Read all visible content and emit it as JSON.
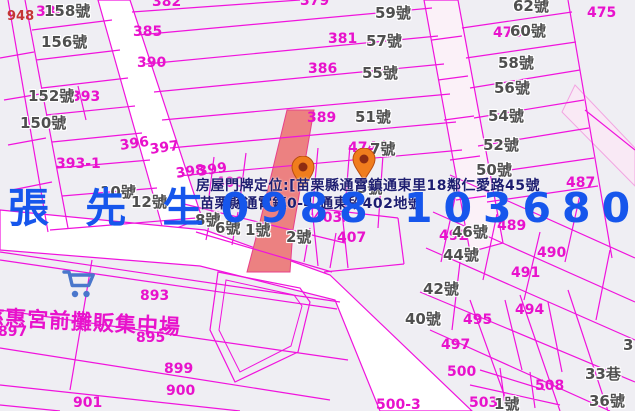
{
  "map": {
    "overlay": {
      "contact_name": "張 先 生",
      "contact_phone": "0988 103680",
      "address_line1": "房屋門牌定位:[苗栗縣通霄鎮通東里18鄰仁愛路45號",
      "address_line2": "苗栗縣通霄鎮0-4 通東段402地號"
    },
    "market_label": "慈惠宮前攤販集中場",
    "icons": {
      "market": "shopping-cart-icon",
      "marker": "location-pin-icon"
    },
    "colors": {
      "parcel_line": "#f013dd",
      "label_magenta": "#e812cc",
      "label_grey": "#4f4f4f",
      "label_red": "#c43535",
      "overlay_blue": "#1656ec",
      "address_navy": "#1d1d70",
      "highlight_parcel": "#ec8181",
      "marker_orange": "#f07d1d",
      "cart_blue": "#4a77cc",
      "road_white": "#ffffff",
      "map_background": "#efeef3"
    },
    "markers": [
      {
        "x": 303,
        "y": 194
      },
      {
        "x": 364,
        "y": 186
      }
    ],
    "labels": [
      {
        "t": "382",
        "x": 152,
        "y": -5,
        "c": "m"
      },
      {
        "t": "379",
        "x": 300,
        "y": -6,
        "c": "m"
      },
      {
        "t": "384",
        "x": 36,
        "y": 5,
        "c": "m"
      },
      {
        "t": "385",
        "x": 133,
        "y": 25,
        "c": "m"
      },
      {
        "t": "381",
        "x": 328,
        "y": 32,
        "c": "m"
      },
      {
        "t": "390",
        "x": 137,
        "y": 56,
        "c": "m"
      },
      {
        "t": "386",
        "x": 308,
        "y": 62,
        "c": "m"
      },
      {
        "t": "389",
        "x": 307,
        "y": 111,
        "c": "m"
      },
      {
        "t": "393",
        "x": 71,
        "y": 90,
        "c": "m"
      },
      {
        "t": "393-1",
        "x": 56,
        "y": 157,
        "c": "m"
      },
      {
        "t": "396",
        "x": 119,
        "y": 139,
        "c": "m",
        "rot": -8
      },
      {
        "t": "397",
        "x": 149,
        "y": 143,
        "c": "m",
        "rot": -8
      },
      {
        "t": "398",
        "x": 175,
        "y": 167,
        "c": "m",
        "rot": -8
      },
      {
        "t": "399",
        "x": 197,
        "y": 165,
        "c": "m",
        "rot": -8
      },
      {
        "t": "400",
        "x": 215,
        "y": 176,
        "c": "m"
      },
      {
        "t": "403",
        "x": 313,
        "y": 211,
        "c": "m"
      },
      {
        "t": "407",
        "x": 337,
        "y": 231,
        "c": "m"
      },
      {
        "t": "474",
        "x": 348,
        "y": 141,
        "c": "m"
      },
      {
        "t": "476",
        "x": 493,
        "y": 26,
        "c": "m"
      },
      {
        "t": "475",
        "x": 587,
        "y": 6,
        "c": "m"
      },
      {
        "t": "487",
        "x": 566,
        "y": 176,
        "c": "m"
      },
      {
        "t": "489",
        "x": 497,
        "y": 219,
        "c": "m"
      },
      {
        "t": "492",
        "x": 439,
        "y": 229,
        "c": "m"
      },
      {
        "t": "490",
        "x": 537,
        "y": 246,
        "c": "m"
      },
      {
        "t": "491",
        "x": 511,
        "y": 266,
        "c": "m"
      },
      {
        "t": "494",
        "x": 515,
        "y": 303,
        "c": "m"
      },
      {
        "t": "495",
        "x": 463,
        "y": 313,
        "c": "m"
      },
      {
        "t": "497",
        "x": 441,
        "y": 338,
        "c": "m"
      },
      {
        "t": "500",
        "x": 447,
        "y": 365,
        "c": "m"
      },
      {
        "t": "508",
        "x": 535,
        "y": 379,
        "c": "m"
      },
      {
        "t": "503",
        "x": 469,
        "y": 396,
        "c": "m"
      },
      {
        "t": "500-3",
        "x": 376,
        "y": 398,
        "c": "m"
      },
      {
        "t": "893",
        "x": 140,
        "y": 289,
        "c": "m"
      },
      {
        "t": "895",
        "x": 136,
        "y": 331,
        "c": "m"
      },
      {
        "t": "897",
        "x": -2,
        "y": 325,
        "c": "m"
      },
      {
        "t": "899",
        "x": 164,
        "y": 362,
        "c": "m"
      },
      {
        "t": "900",
        "x": 166,
        "y": 384,
        "c": "m"
      },
      {
        "t": "901",
        "x": 73,
        "y": 396,
        "c": "m"
      },
      {
        "t": "158號",
        "x": 44,
        "y": 4,
        "c": "g"
      },
      {
        "t": "156號",
        "x": 41,
        "y": 35,
        "c": "g"
      },
      {
        "t": "152號",
        "x": 28,
        "y": 89,
        "c": "g"
      },
      {
        "t": "150號",
        "x": 20,
        "y": 116,
        "c": "g"
      },
      {
        "t": "59號",
        "x": 375,
        "y": 6,
        "c": "g"
      },
      {
        "t": "57號",
        "x": 366,
        "y": 34,
        "c": "g"
      },
      {
        "t": "55號",
        "x": 362,
        "y": 66,
        "c": "g"
      },
      {
        "t": "51號",
        "x": 355,
        "y": 110,
        "c": "g"
      },
      {
        "t": "62號",
        "x": 513,
        "y": -1,
        "c": "g"
      },
      {
        "t": "60號",
        "x": 510,
        "y": 24,
        "c": "g"
      },
      {
        "t": "58號",
        "x": 498,
        "y": 56,
        "c": "g"
      },
      {
        "t": "56號",
        "x": 494,
        "y": 81,
        "c": "g"
      },
      {
        "t": "54號",
        "x": 488,
        "y": 109,
        "c": "g"
      },
      {
        "t": "52號",
        "x": 483,
        "y": 138,
        "c": "g"
      },
      {
        "t": "50號",
        "x": 476,
        "y": 163,
        "c": "g"
      },
      {
        "t": "7號",
        "x": 370,
        "y": 142,
        "c": "g"
      },
      {
        "t": "5號",
        "x": 357,
        "y": 181,
        "c": "g"
      },
      {
        "t": "10號",
        "x": 100,
        "y": 185,
        "c": "g"
      },
      {
        "t": "12號",
        "x": 131,
        "y": 195,
        "c": "g"
      },
      {
        "t": "8號",
        "x": 195,
        "y": 213,
        "c": "g"
      },
      {
        "t": "6號",
        "x": 215,
        "y": 221,
        "c": "g"
      },
      {
        "t": "1號",
        "x": 245,
        "y": 223,
        "c": "g"
      },
      {
        "t": "2號",
        "x": 286,
        "y": 230,
        "c": "g"
      },
      {
        "t": "46號",
        "x": 452,
        "y": 225,
        "c": "g"
      },
      {
        "t": "44號",
        "x": 443,
        "y": 248,
        "c": "g"
      },
      {
        "t": "42號",
        "x": 423,
        "y": 282,
        "c": "g"
      },
      {
        "t": "40號",
        "x": 405,
        "y": 312,
        "c": "g"
      },
      {
        "t": "1號",
        "x": 494,
        "y": 397,
        "c": "g"
      },
      {
        "t": "33巷",
        "x": 585,
        "y": 367,
        "c": "g"
      },
      {
        "t": "36號",
        "x": 589,
        "y": 394,
        "c": "g"
      },
      {
        "t": "3",
        "x": 623,
        "y": 338,
        "c": "g"
      },
      {
        "t": "948",
        "x": 7,
        "y": 10,
        "c": "r"
      }
    ]
  }
}
